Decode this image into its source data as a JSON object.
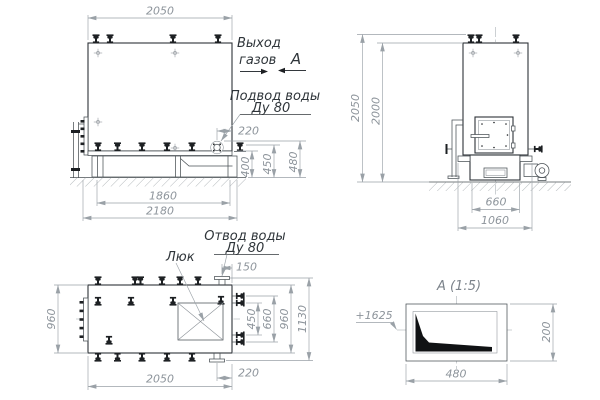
{
  "front_view": {
    "width_top": "2050",
    "frame_width": "1860",
    "base_width": "2180",
    "nozzle_offset": "220",
    "h_400": "400",
    "h_450": "450",
    "h_480": "480",
    "gas_out_line1": "Выход",
    "gas_out_line2": "газов",
    "section_mark": "А",
    "water_in_line1": "Подвод воды",
    "water_in_line2": "Ду 80"
  },
  "side_view": {
    "height_total": "2050",
    "height_body": "2000",
    "furnace_width": "660",
    "base_width": "1060"
  },
  "top_view": {
    "hatch_label": "Люк",
    "water_out_line1": "Отвод воды",
    "water_out_line2": "Ду 80",
    "nozzle_offset_top": "150",
    "nozzle_pitch": "450",
    "nozzle_span": "660",
    "body_width_right": "960",
    "overall_width": "1130",
    "body_width_left": "960",
    "length": "2050",
    "nozzle_offset_bottom": "220"
  },
  "detail_a": {
    "title": "А (1:5)",
    "elevation": "+1625",
    "width": "480",
    "height": "200"
  },
  "colors": {
    "line_dark": "#2e3338",
    "line_medium": "#4a5055",
    "dimension": "#9aa1a7",
    "dim_text": "#8d949b",
    "label_text": "#2f353a",
    "dark_fill": "#1d2023",
    "background": "#ffffff"
  }
}
